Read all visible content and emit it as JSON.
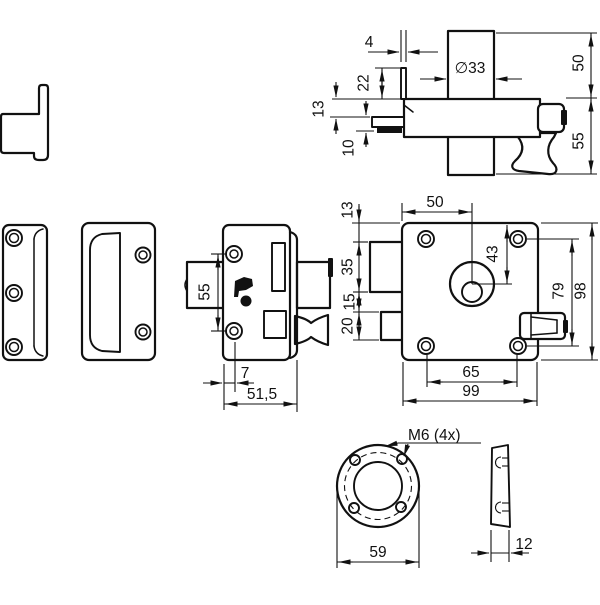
{
  "drawing_type": "technical dimension drawing",
  "part": "rim lock with cylinder, strike plates and rosette",
  "colors": {
    "line": "#111111",
    "background": "#ffffff"
  },
  "views": {
    "cylinder_side": {
      "dims": {
        "flange_width": "4",
        "cylinder_diameter": "∅33",
        "flange_height": "22",
        "tail_offset": "13",
        "tail_thickness": "10",
        "upper_height": "50",
        "lower_height": "55"
      }
    },
    "lock_front": {
      "dims": {
        "cylinder_center_offset": "50",
        "top_margin": "13",
        "housing_height": "35",
        "spacing": "15",
        "bolt_height": "20",
        "center_depth": "43",
        "hole_pitch_vertical": "79",
        "case_height": "98",
        "hole_pitch_horizontal": "65",
        "case_width": "99"
      }
    },
    "lock_side": {
      "dims": {
        "hole_pitch": "55",
        "edge_to_hole": "7",
        "case_depth": "51,5"
      }
    },
    "rosette_front": {
      "dims": {
        "thread_callout": "M6  (4x)",
        "outer_diameter": "59"
      }
    },
    "rosette_side": {
      "dims": {
        "thickness": "12"
      }
    }
  }
}
